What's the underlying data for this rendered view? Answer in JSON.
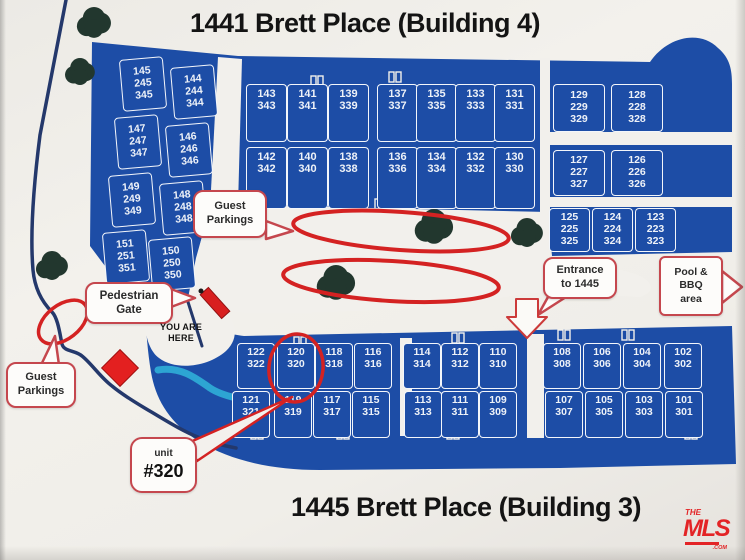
{
  "titles": {
    "top": "1441 Brett Place (Building 4)",
    "bottom": "1445 Brett Place (Building 3)"
  },
  "callouts": {
    "guest_top": [
      "Guest",
      "Parkings"
    ],
    "pedestrian": [
      "Pedestrian",
      "Gate"
    ],
    "guest_left": [
      "Guest",
      "Parkings"
    ],
    "entrance": [
      "Entrance",
      "to 1445"
    ],
    "pool": [
      "Pool &",
      "BBQ",
      "area"
    ],
    "unit": [
      "unit",
      "#320"
    ],
    "you_are_here": [
      "YOU ARE",
      "HERE"
    ]
  },
  "units": {
    "left_wing": [
      [
        "145",
        "245",
        "345"
      ],
      [
        "144",
        "244",
        "344"
      ],
      [
        "147",
        "247",
        "347"
      ],
      [
        "146",
        "246",
        "346"
      ],
      [
        "149",
        "249",
        "349"
      ],
      [
        "148",
        "248",
        "348"
      ],
      [
        "151",
        "251",
        "351"
      ],
      [
        "150",
        "250",
        "350"
      ]
    ],
    "top_row1": [
      [
        "143",
        "343"
      ],
      [
        "141",
        "341"
      ],
      [
        "139",
        "339"
      ],
      [
        "137",
        "337"
      ],
      [
        "135",
        "335"
      ],
      [
        "133",
        "333"
      ],
      [
        "131",
        "331"
      ]
    ],
    "top_row2": [
      [
        "142",
        "342"
      ],
      [
        "140",
        "340"
      ],
      [
        "138",
        "338"
      ],
      [
        "136",
        "336"
      ],
      [
        "134",
        "334"
      ],
      [
        "132",
        "332"
      ],
      [
        "130",
        "330"
      ]
    ],
    "right_row1": [
      [
        "129",
        "229",
        "329"
      ],
      [
        "128",
        "228",
        "328"
      ]
    ],
    "right_row2": [
      [
        "127",
        "227",
        "327"
      ],
      [
        "126",
        "226",
        "326"
      ]
    ],
    "right_row3": [
      [
        "125",
        "225",
        "325"
      ],
      [
        "124",
        "224",
        "324"
      ],
      [
        "123",
        "223",
        "323"
      ]
    ],
    "bottom_row1": [
      [
        "122",
        "322"
      ],
      [
        "120",
        "320"
      ],
      [
        "118",
        "318"
      ],
      [
        "116",
        "316"
      ],
      [
        "114",
        "314"
      ],
      [
        "112",
        "312"
      ],
      [
        "110",
        "310"
      ],
      [
        "108",
        "308"
      ],
      [
        "106",
        "306"
      ],
      [
        "104",
        "304"
      ],
      [
        "102",
        "302"
      ]
    ],
    "bottom_row2": [
      [
        "121",
        "321"
      ],
      [
        "119",
        "319"
      ],
      [
        "117",
        "317"
      ],
      [
        "115",
        "315"
      ],
      [
        "113",
        "313"
      ],
      [
        "111",
        "311"
      ],
      [
        "109",
        "309"
      ],
      [
        "107",
        "307"
      ],
      [
        "105",
        "305"
      ],
      [
        "103",
        "303"
      ],
      [
        "101",
        "301"
      ]
    ]
  },
  "logo": {
    "the": "THE",
    "mls": "MLS",
    "com": ".COM"
  },
  "colors": {
    "building_blue": "#1d4da6",
    "sign_white": "#f2f0ec",
    "annotation_red": "#d42222",
    "callout_border": "#c5474e",
    "boundary_navy": "#24386b",
    "path_cyan": "#2da5d3",
    "tree_green": "#22372e",
    "logo_red": "#e32426"
  }
}
